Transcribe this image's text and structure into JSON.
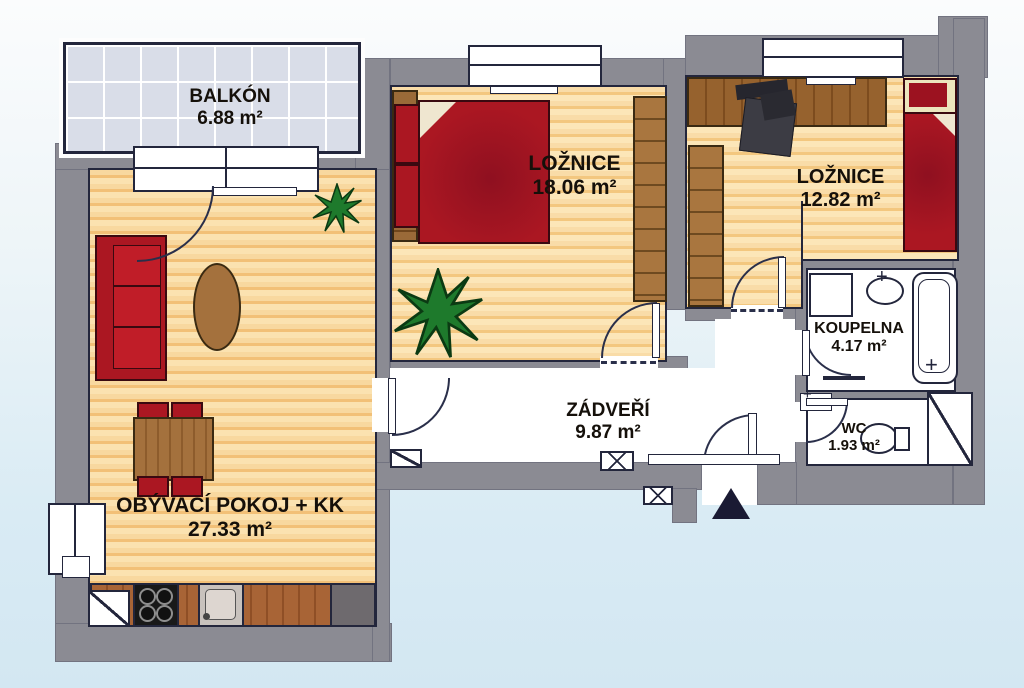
{
  "document": {
    "type": "apartment-floor-plan",
    "style": "scanned color plan"
  },
  "rooms": {
    "balkon": {
      "label": "BALKÓN",
      "area": "6.88 m²"
    },
    "loznice1": {
      "label": "LOŽNICE",
      "area": "18.06 m²"
    },
    "loznice2": {
      "label": "LOŽNICE",
      "area": "12.82 m²"
    },
    "koupelna": {
      "label": "KOUPELNA",
      "area": "4.17 m²"
    },
    "wc": {
      "label": "WC",
      "area": "1.93 m²"
    },
    "zadveri": {
      "label": "ZÁDVEŘÍ",
      "area": "9.87 m²"
    },
    "obyvaci": {
      "label": "OBÝVACÍ POKOJ + KK",
      "area": "27.33 m²"
    }
  },
  "colors": {
    "wall": "#8b8b93",
    "outline": "#23263c",
    "floor_wood": "#f6cf92",
    "balcony_tile": "#d9dde8",
    "furniture_red": "#ab1722",
    "furniture_brown": "#9a6a38",
    "plant_green": "#1e7a2c",
    "background_bottom": "#d3e7f2",
    "entrance_marker": "#1a1a33"
  },
  "symbols": [
    "window",
    "door-arc",
    "entrance-triangle",
    "bathtub",
    "washbasin",
    "toilet",
    "washing-machine",
    "stove",
    "kitchen-sink",
    "fridge",
    "sofa",
    "double-bed",
    "single-bed",
    "wardrobe",
    "desk",
    "dining-table",
    "coffee-table",
    "plant",
    "shaft",
    "electrical-box",
    "radiator"
  ]
}
